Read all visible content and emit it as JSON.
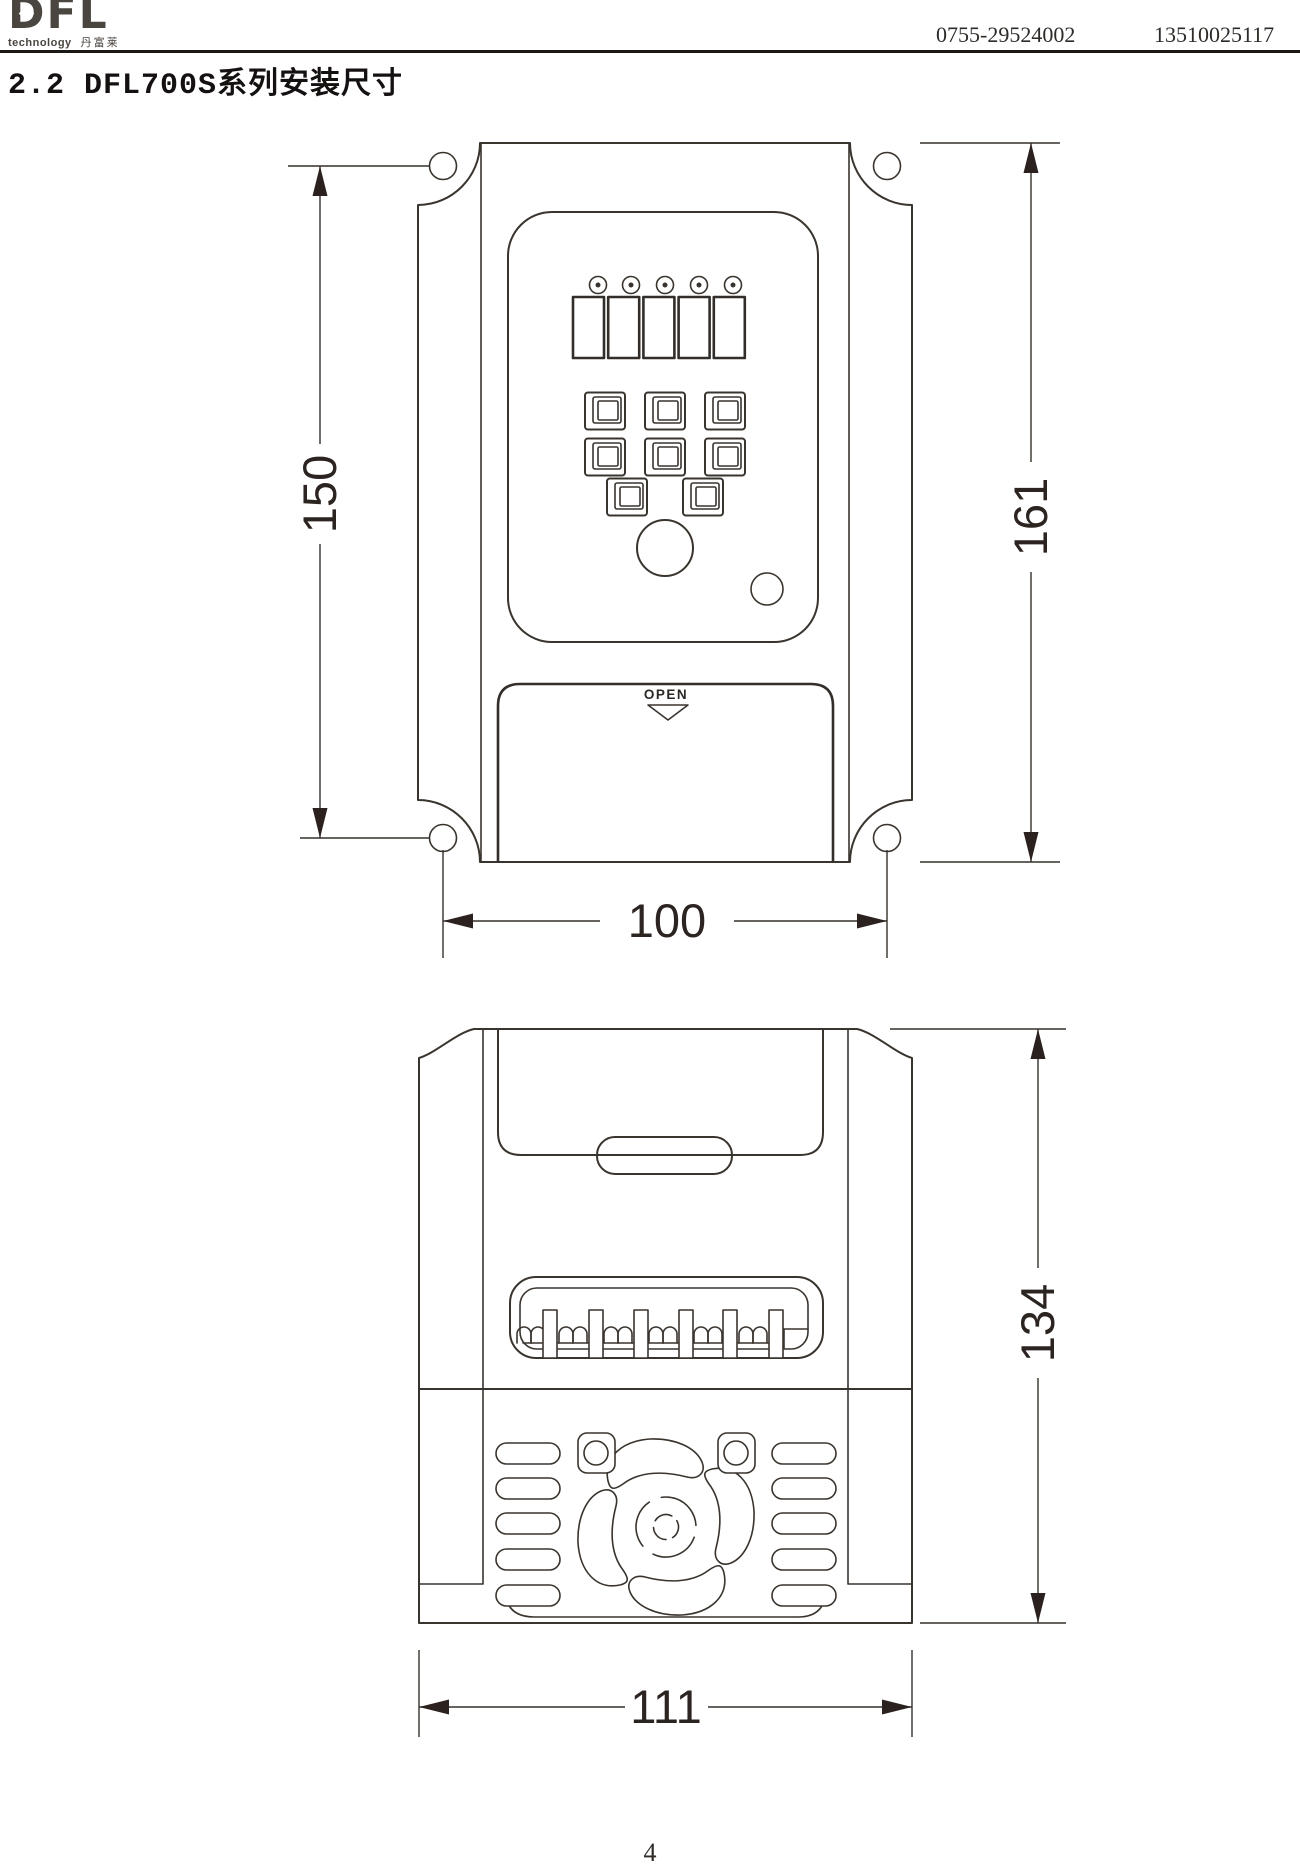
{
  "header": {
    "logo_text": "DFL",
    "logo_tagline": "technology",
    "logo_cn": "丹富莱",
    "phone_1": "0755-29524002",
    "phone_2": "13510025117"
  },
  "title": "2.2 DFL700S系列安装尺寸",
  "front_view": {
    "label_open": "OPEN",
    "dim_mounting_height": "150",
    "dim_overall_height": "161",
    "dim_mounting_width": "100"
  },
  "side_view": {
    "dim_overall_height": "134",
    "dim_overall_width": "111"
  },
  "footer": {
    "page_number": "4"
  },
  "colors": {
    "line": "#3a342e",
    "dim_text": "#2b2420",
    "paper": "#ffffff",
    "rule": "#1b1815"
  }
}
